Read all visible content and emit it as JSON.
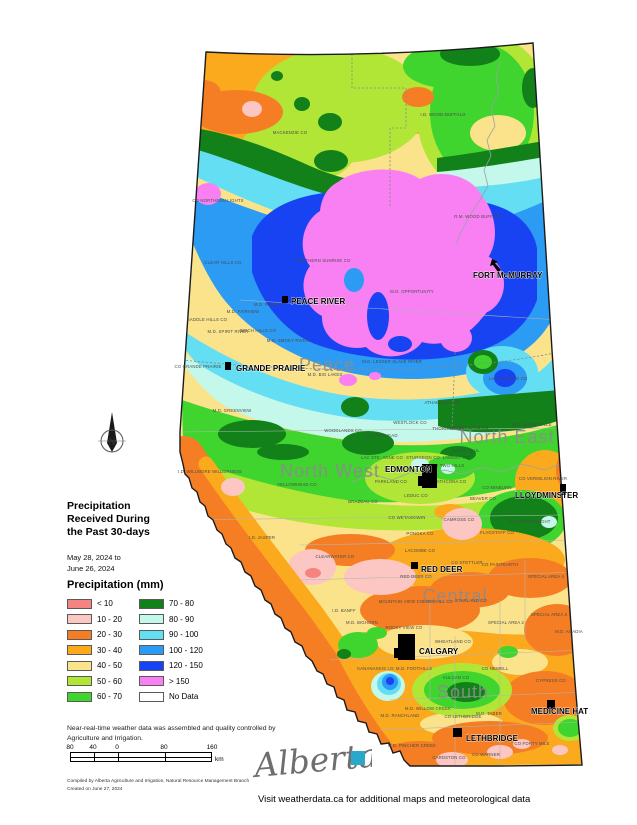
{
  "title": {
    "lines": [
      "Precipitation",
      "Received During",
      "the Past 30-days"
    ]
  },
  "date_range": {
    "lines": [
      "May 28, 2024 to",
      "June 26, 2024"
    ]
  },
  "legend": {
    "header": "Precipitation (mm)",
    "items": [
      {
        "label": "< 10",
        "color": "#f5837f"
      },
      {
        "label": "10 - 20",
        "color": "#fcc6c2"
      },
      {
        "label": "20 - 30",
        "color": "#f57e24"
      },
      {
        "label": "30 - 40",
        "color": "#fbaa1d"
      },
      {
        "label": "40 - 50",
        "color": "#fae38b"
      },
      {
        "label": "50 - 60",
        "color": "#b2e636"
      },
      {
        "label": "60 - 70",
        "color": "#3fd42e"
      },
      {
        "label": "70 - 80",
        "color": "#12811a"
      },
      {
        "label": "80 - 90",
        "color": "#c4f8ea"
      },
      {
        "label": "90 - 100",
        "color": "#63def2"
      },
      {
        "label": "100 - 120",
        "color": "#2b9bf4"
      },
      {
        "label": "120 - 150",
        "color": "#1843f2"
      },
      {
        "label": "> 150",
        "color": "#f980f2"
      },
      {
        "label": "No Data",
        "color": "#ffffff"
      }
    ]
  },
  "compass": {
    "label": "N"
  },
  "map": {
    "region_labels": [
      {
        "t": "Peace",
        "x": 327,
        "y": 371,
        "s": 18
      },
      {
        "t": "North West",
        "x": 330,
        "y": 477,
        "s": 18
      },
      {
        "t": "North East",
        "x": 507,
        "y": 443,
        "s": 18
      },
      {
        "t": "Central",
        "x": 455,
        "y": 602,
        "s": 18
      },
      {
        "t": "South",
        "x": 463,
        "y": 698,
        "s": 18
      }
    ],
    "cities": [
      {
        "name": "FORT McMURRAY",
        "lx": 473,
        "ly": 278,
        "marker": "arrow",
        "mx": 497,
        "my": 266
      },
      {
        "name": "PEACE RIVER",
        "lx": 291,
        "ly": 304,
        "marker": "rect",
        "mx": 282,
        "my": 296,
        "mw": 6,
        "mh": 7
      },
      {
        "name": "GRANDE PRAIRIE",
        "lx": 236,
        "ly": 371,
        "marker": "rect",
        "mx": 225,
        "my": 362,
        "mw": 6,
        "mh": 8
      },
      {
        "name": "EDMONTON",
        "lx": 385,
        "ly": 472,
        "marker": "blob",
        "mx": 422,
        "my": 464,
        "mw": 15,
        "mh": 24
      },
      {
        "name": "LLOYDMINSTER",
        "lx": 515,
        "ly": 498,
        "marker": "rect",
        "mx": 560,
        "my": 484,
        "mw": 6,
        "mh": 11
      },
      {
        "name": "RED DEER",
        "lx": 421,
        "ly": 572,
        "marker": "rect",
        "mx": 411,
        "my": 562,
        "mw": 7,
        "mh": 7
      },
      {
        "name": "CALGARY",
        "lx": 419,
        "ly": 654,
        "marker": "blob",
        "mx": 398,
        "my": 634,
        "mw": 17,
        "mh": 26
      },
      {
        "name": "MEDICINE HAT",
        "lx": 531,
        "ly": 714,
        "marker": "rect",
        "mx": 547,
        "my": 700,
        "mw": 8,
        "mh": 9
      },
      {
        "name": "LETHBRIDGE",
        "lx": 466,
        "ly": 741,
        "marker": "rect",
        "mx": 453,
        "my": 728,
        "mw": 9,
        "mh": 9
      }
    ],
    "counties": [
      [
        "I.D. WOOD-BUFFALO",
        443,
        116
      ],
      [
        "MACKENZIE CO",
        290,
        134
      ],
      [
        "CO NORTHERN LIGHTS",
        218,
        202
      ],
      [
        "R.M. WOOD BUFFALO",
        478,
        218
      ],
      [
        "CLEAR HILLS CO",
        223,
        264
      ],
      [
        "NORTHERN SUNRISE CO",
        323,
        262
      ],
      [
        "M.D. OPPORTUNITY",
        412,
        293
      ],
      [
        "M.D. PEACE",
        267,
        306
      ],
      [
        "M.D. FAIRVIEW",
        243,
        313
      ],
      [
        "SADDLE HILLS CO",
        207,
        321
      ],
      [
        "M.D. SPIRIT RIVER",
        228,
        333
      ],
      [
        "BIRCH HILLS CO",
        258,
        332
      ],
      [
        "M.D. SMOKY RIVER",
        288,
        342
      ],
      [
        "CO GRANDE PRAIRIE",
        198,
        368
      ],
      [
        "M.D. BIG LAKES",
        325,
        376
      ],
      [
        "M.D. LESSER SLAVE RIVER",
        392,
        363
      ],
      [
        "M.D. GREENVIEW",
        232,
        412
      ],
      [
        "LAC LA BICHE CO",
        508,
        380
      ],
      [
        "ATHABASCA CO",
        442,
        404
      ],
      [
        "WESTLOCK CO",
        410,
        424
      ],
      [
        "WOODLANDS CO",
        343,
        432
      ],
      [
        "CO BARRHEAD",
        381,
        437
      ],
      [
        "SMOKY LAKE CO",
        470,
        429
      ],
      [
        "THORHILD CO",
        448,
        430
      ],
      [
        "M.D. BONNYVILLE",
        532,
        426
      ],
      [
        "CO ST. PAUL",
        466,
        452
      ],
      [
        "CO TWO HILLS",
        448,
        467
      ],
      [
        "CO VERMILION RIVER",
        543,
        480
      ],
      [
        "CO MINBURN",
        497,
        489
      ],
      [
        "LAC STE. ANNE CO",
        382,
        459
      ],
      [
        "STURGEON CO",
        423,
        459
      ],
      [
        "LAMONT CO",
        456,
        459
      ],
      [
        "YELLOWHEAD CO",
        297,
        486
      ],
      [
        "PARKLAND CO",
        391,
        483
      ],
      [
        "STRATHCONA CO",
        447,
        483
      ],
      [
        "LEDUC CO",
        416,
        497
      ],
      [
        "BRAZEAU CO",
        363,
        503
      ],
      [
        "CO WETASKIWIN",
        407,
        519
      ],
      [
        "BEAVER CO",
        483,
        500
      ],
      [
        "CAMROSE CO",
        459,
        521
      ],
      [
        "FLAGSTAFF CO",
        497,
        534
      ],
      [
        "M.D. WAINWRIGHT",
        530,
        523
      ],
      [
        "PONOKA CO",
        420,
        535
      ],
      [
        "LACOMBE CO",
        420,
        552
      ],
      [
        "CO STETTLER",
        467,
        564
      ],
      [
        "CO PAINTEARTH",
        500,
        566
      ],
      [
        "CLEARWATER CO",
        335,
        558
      ],
      [
        "RED DEER CO",
        416,
        578
      ],
      [
        "I.D. JASPER",
        262,
        539
      ],
      [
        "I.D. WILLMORE WILDERNESS",
        210,
        473
      ],
      [
        "MOUNTAIN VIEW CO",
        401,
        603
      ],
      [
        "KNEEHILL CO",
        438,
        603
      ],
      [
        "STARLAND CO",
        471,
        602
      ],
      [
        "SPECIAL AREA 2",
        506,
        624
      ],
      [
        "SPECIAL AREA 3",
        549,
        616
      ],
      [
        "SPECIAL AREA 4",
        546,
        578
      ],
      [
        "M.D. ACADIA",
        569,
        633
      ],
      [
        "I.D. BANFF",
        344,
        612
      ],
      [
        "M.D. BIGHORN",
        362,
        624
      ],
      [
        "ROCKY VIEW CO",
        404,
        629
      ],
      [
        "WHEATLAND CO",
        453,
        643
      ],
      [
        "CO NEWELL",
        495,
        670
      ],
      [
        "CYPRESS CO",
        551,
        682
      ],
      [
        "VULCAN CO",
        456,
        679
      ],
      [
        "KANANASKIS I.D.",
        376,
        670
      ],
      [
        "M.D. FOOTHILLS",
        414,
        670
      ],
      [
        "M.D. RANCHLAND",
        400,
        717
      ],
      [
        "M.D. WILLOW CREEK",
        428,
        710
      ],
      [
        "M.D. TABER",
        489,
        715
      ],
      [
        "CO LETHBRIDGE",
        463,
        718
      ],
      [
        "M.D. PINCHER CREEK",
        412,
        747
      ],
      [
        "CARDSTON CO",
        449,
        759
      ],
      [
        "CO WARNER",
        486,
        756
      ],
      [
        "CO FORTY MILE",
        532,
        745
      ]
    ]
  },
  "footer": {
    "note_lines": [
      "Near-real-time weather data was assembled and quality controlled by",
      "Agriculture and Irrigation."
    ],
    "scale": {
      "ticks": [
        {
          "t": "80",
          "x": 3
        },
        {
          "t": "40",
          "x": 26
        },
        {
          "t": "0",
          "x": 50
        },
        {
          "t": "80",
          "x": 97
        },
        {
          "t": "160",
          "x": 145
        }
      ],
      "unit": "km"
    },
    "compiled_lines": [
      "Compiled by Alberta Agriculture and Irrigation, Natural Resource Management Branch",
      "Created on June 27, 2024"
    ],
    "logo_text": "Alberta",
    "visit_note": "Visit weatherdata.ca for additional maps and meteorological data"
  }
}
